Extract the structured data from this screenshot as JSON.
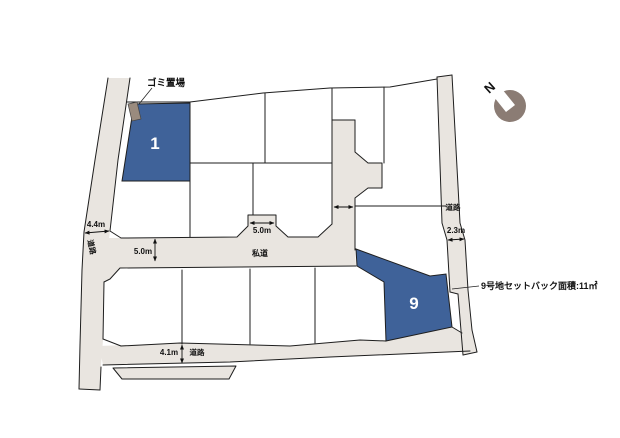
{
  "colors": {
    "road_fill": "#e9e5e0",
    "lot_blue": "#3f6299",
    "garbage_fill": "#9a8b7e",
    "compass_fill": "#8b7c74"
  },
  "lots": {
    "lot1": "1",
    "lot9": "9"
  },
  "labels": {
    "garbage": "ゴミ置場",
    "road": "道路",
    "private_road": "私道",
    "north": "N",
    "setback_note": "9号地セットバック面積:11㎡"
  },
  "measurements": {
    "left_road": "4.4m",
    "private_road_width": "5.0m",
    "stub_width": "5.0m",
    "branch_width": "4.5m",
    "right_road": "2.3m",
    "bottom_road": "4.1m"
  }
}
